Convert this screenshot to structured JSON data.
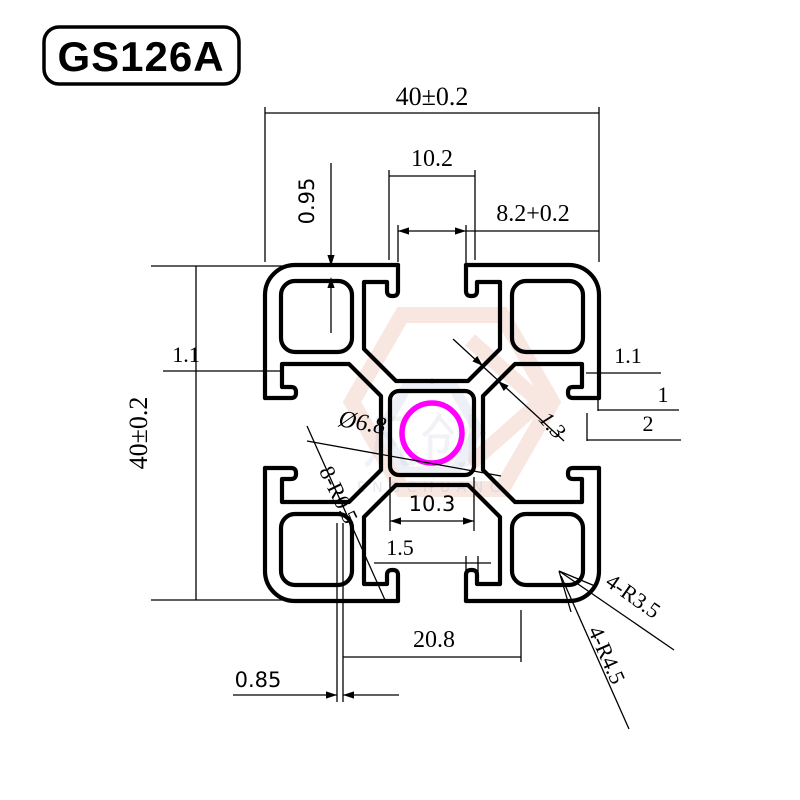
{
  "title": "GS126A",
  "colors": {
    "line": "#000000",
    "hole_highlight": "#ff00ff",
    "watermark_red": "#f3d2ca",
    "watermark_blue": "#dfe5f0"
  },
  "watermark": {
    "zh": "凡创",
    "en": "ENGCHUANG"
  },
  "dims": {
    "overall_width_top": "40±0.2",
    "overall_height_left": "40±0.2",
    "slot_inner_width": "10.2",
    "slot_opening_width": "8.2+0.2",
    "lip_step": "0.95",
    "wall_left": "1.1",
    "wall_right": "1.1",
    "edge_step_1": "1",
    "edge_step_2": "2",
    "center_hole_dia": "Ø6.8",
    "web_thickness": "1.3",
    "hub_inner_width": "10.3",
    "lip_thickness": "1.5",
    "slot_pitch_bottom": "20.8",
    "web_gap": "0.85",
    "fillet_radius_inner": "8-R0.5",
    "corner_radius_outer": "4-R3.5",
    "corner_radius_outer2": "4-R4.5"
  }
}
